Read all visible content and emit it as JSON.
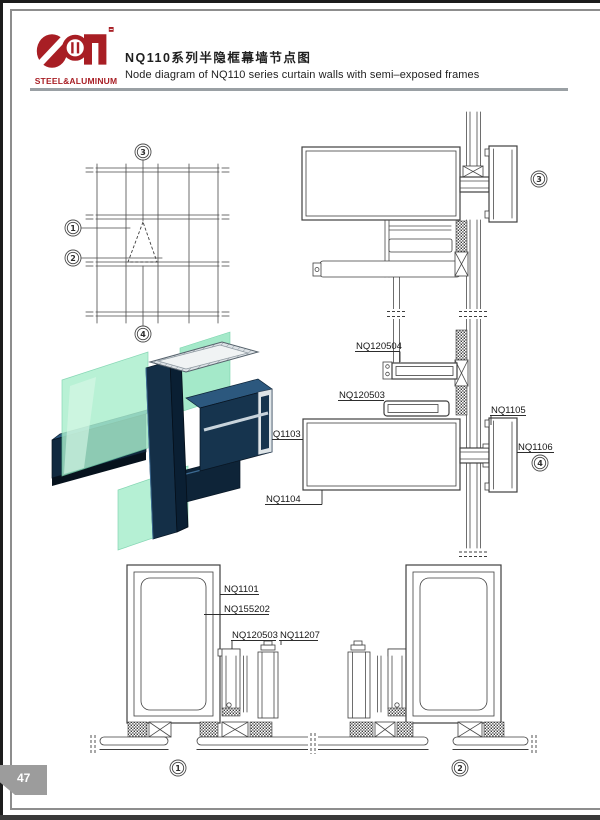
{
  "page": {
    "number": "47"
  },
  "header": {
    "logo_text": "STEEL&ALUMINUM",
    "title_zh": "NQ110系列半隐框幕墙节点图",
    "title_en": "Node diagram of NQ110 series curtain walls with semi–exposed frames"
  },
  "markers": {
    "grid1": "1",
    "grid2": "2",
    "grid3": "3",
    "grid4": "4",
    "sec3": "3",
    "sec4": "4",
    "plan1": "1",
    "plan2": "2"
  },
  "part_labels": {
    "nq120504": "NQ120504",
    "nq120503_mid": "NQ120503",
    "nq1103": "NQ1103",
    "nq1104": "NQ1104",
    "nq1105": "NQ1105",
    "nq1106": "NQ1106",
    "nq1101": "NQ1101",
    "nq155202": "NQ155202",
    "nq120503_bottom": "NQ120503",
    "nq11207": "NQ11207"
  },
  "colors": {
    "brand_red": "#a81e24",
    "tab_gray": "#9c9c9c",
    "line_gray": "#3f3f3f",
    "glass_green": "#a9eecd",
    "frame_navy": "#16344e"
  }
}
